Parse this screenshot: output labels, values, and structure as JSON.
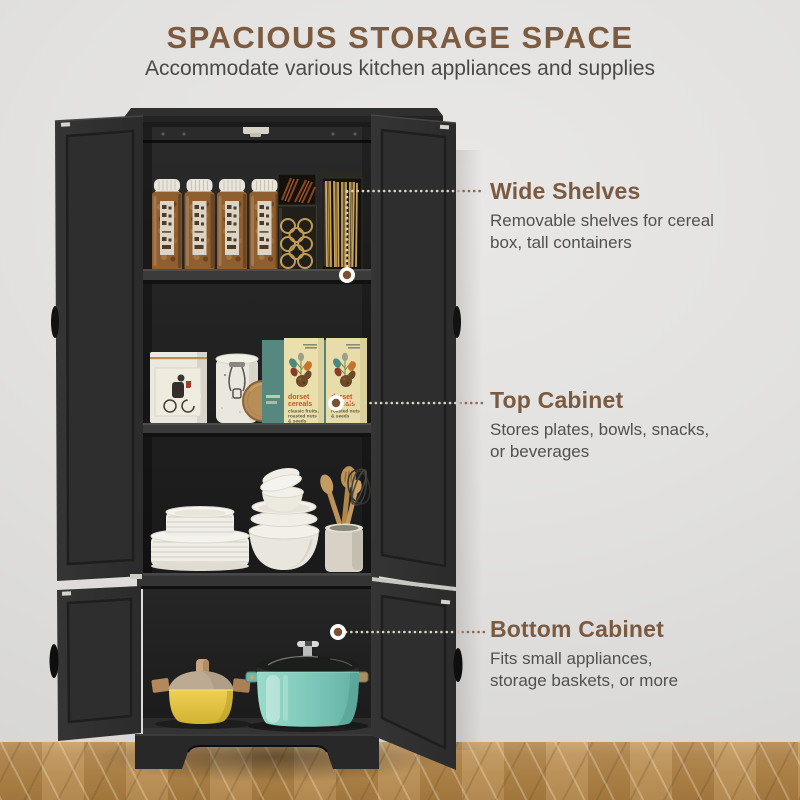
{
  "header": {
    "title": "SPACIOUS STORAGE SPACE",
    "subtitle": "Accommodate various kitchen appliances and supplies"
  },
  "callouts": [
    {
      "heading": "Wide Shelves",
      "body_lines": [
        "Removable shelves for cereal",
        "box, tall containers"
      ]
    },
    {
      "heading": "Top Cabinet",
      "body_lines": [
        "Stores plates, bowls, snacks,",
        "or beverages"
      ]
    },
    {
      "heading": "Bottom Cabinet",
      "body_lines": [
        "Fits small appliances,",
        "storage baskets, or more"
      ]
    }
  ],
  "product": {
    "boxes": {
      "brand_line1": "dorset",
      "brand_line2": "cereals",
      "box1_desc_lines": [
        "classic fruits,",
        "roasted nuts",
        "& seeds"
      ],
      "box2_desc_lines": [
        "roasted nuts",
        "& seeds"
      ]
    }
  },
  "colors": {
    "accent_brown": "#7a5a40",
    "body_text": "#51504d",
    "cabinet_black": "#2e2e2e",
    "wall_gray": "#e3e2e0",
    "floor_wood": "#b08549",
    "pot_yellow": "#e5c64a",
    "pot_teal": "#7cc7b8",
    "marker_dot": "#7a5233"
  }
}
